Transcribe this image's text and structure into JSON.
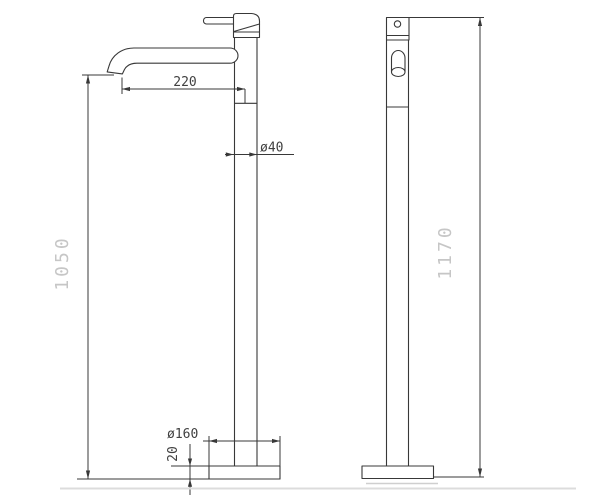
{
  "drawing": {
    "colors": {
      "background": "#ffffff",
      "line": "#383838",
      "dim_text": "#404040",
      "large_dim_text": "#c6c6c6",
      "shadow": "#dcdcdc"
    },
    "views": {
      "front": {
        "dimensions": {
          "spout_reach": "220",
          "pipe_diameter": "ø40",
          "spout_height": "1050",
          "base_diameter": "ø160",
          "base_thickness": "20"
        }
      },
      "side": {
        "dimensions": {
          "total_height": "1170"
        }
      }
    }
  }
}
